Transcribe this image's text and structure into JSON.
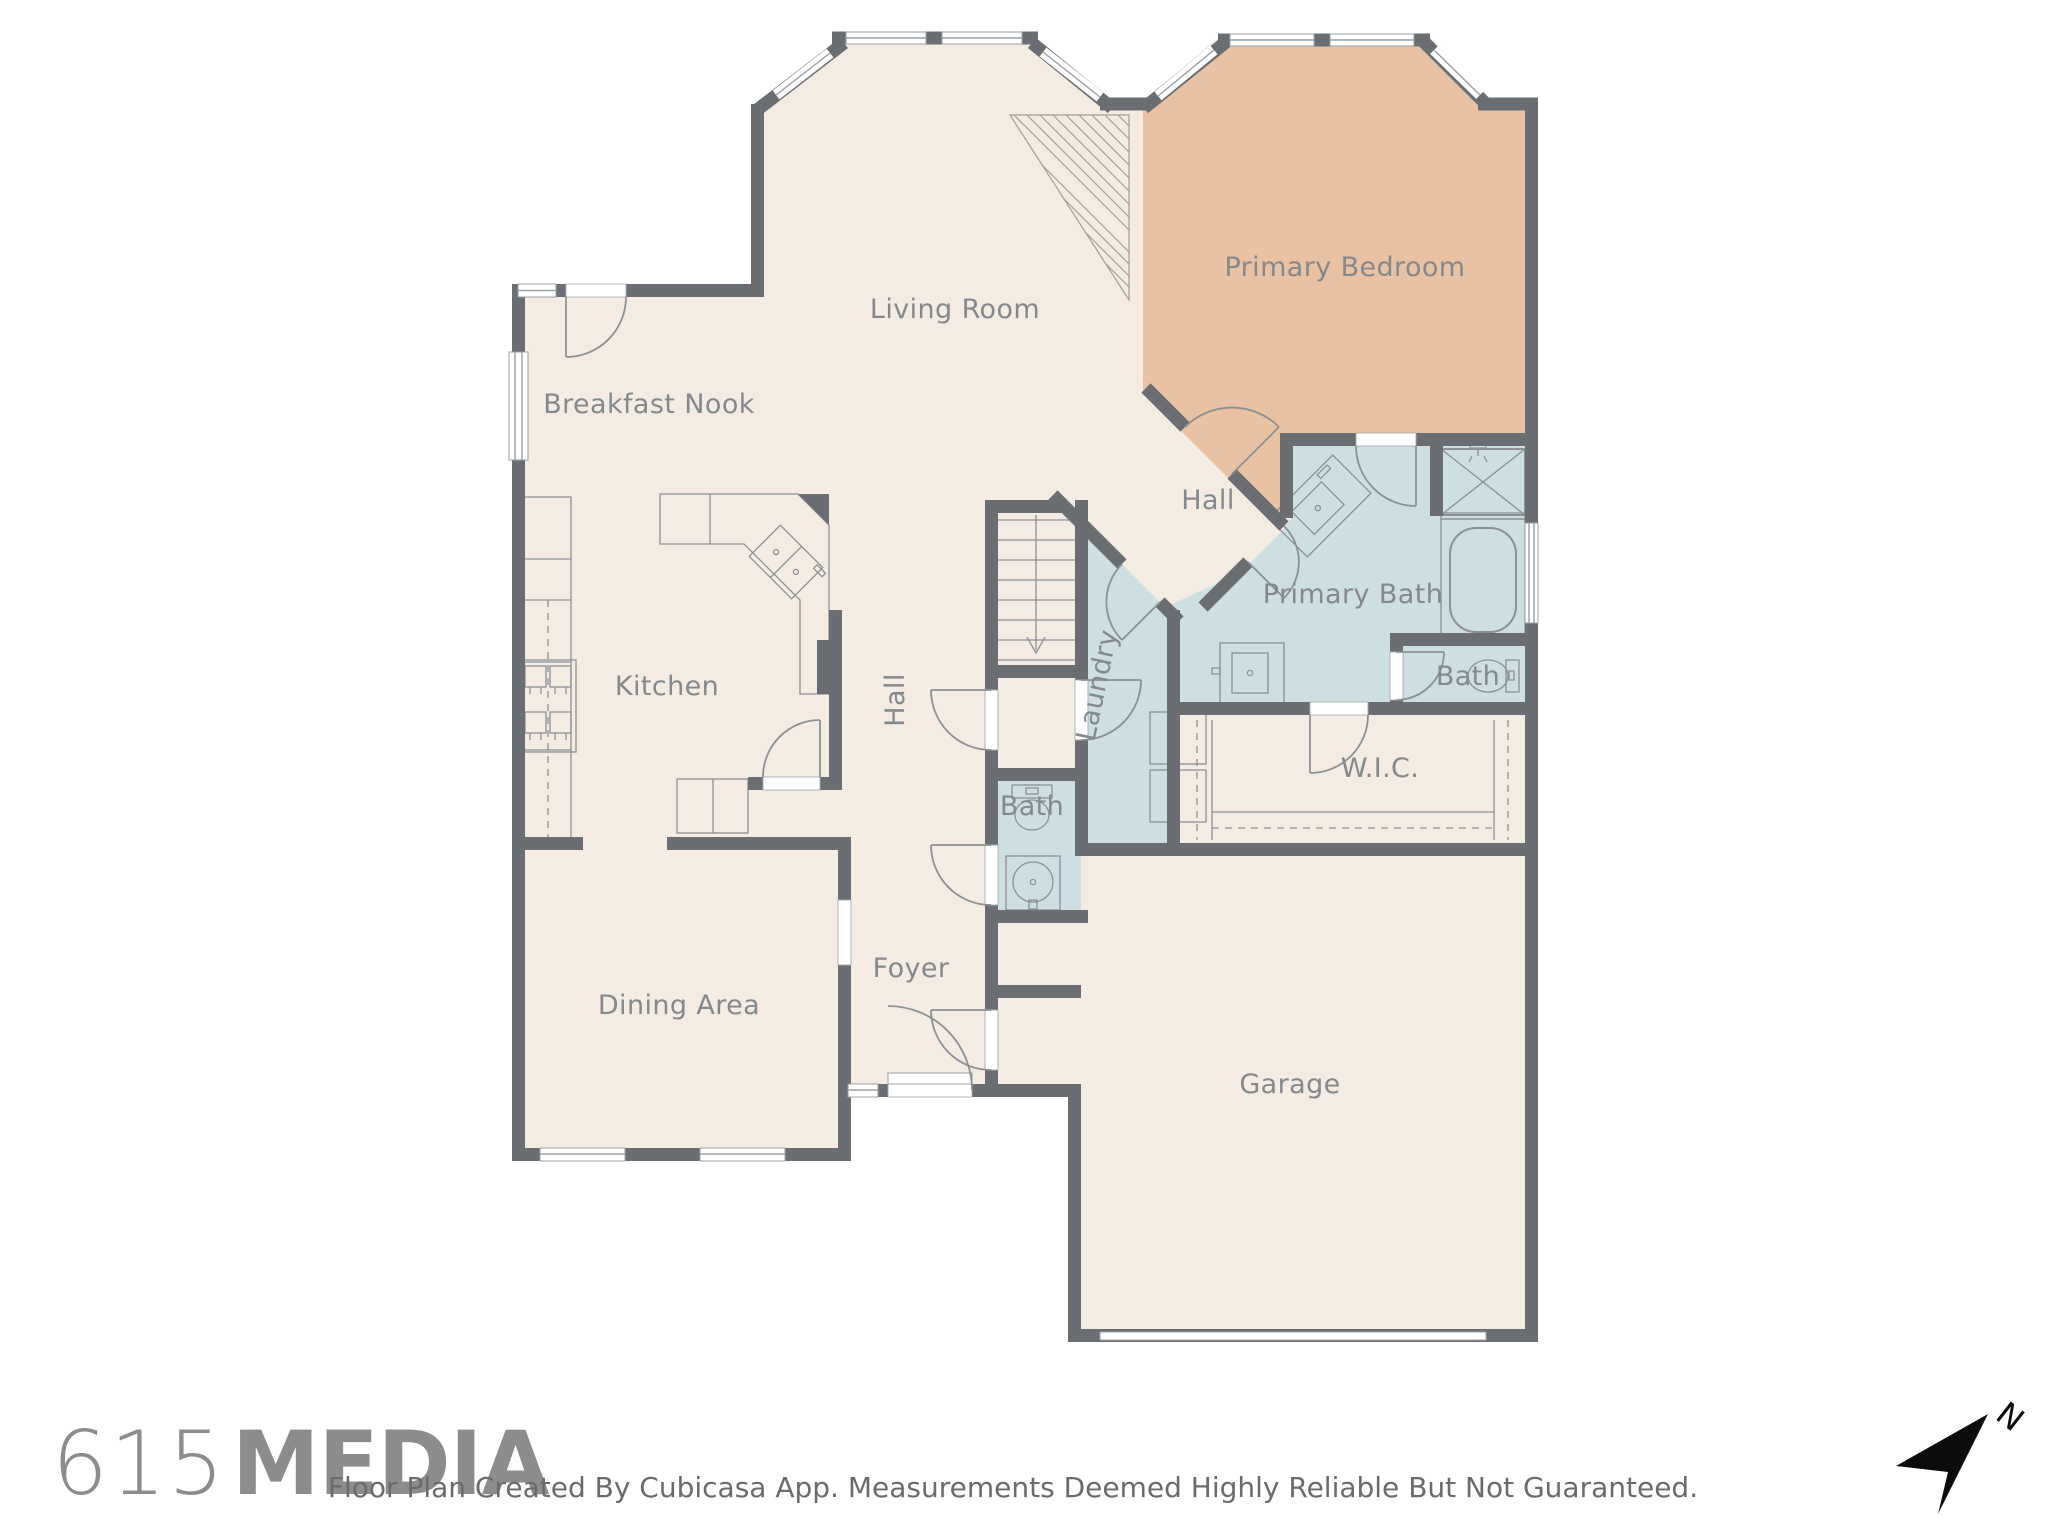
{
  "floorplan": {
    "rooms": [
      {
        "id": "living-room",
        "label": "Living Room"
      },
      {
        "id": "primary-bedroom",
        "label": "Primary Bedroom"
      },
      {
        "id": "breakfast-nook",
        "label": "Breakfast Nook"
      },
      {
        "id": "hall-upper",
        "label": "Hall"
      },
      {
        "id": "primary-bath",
        "label": "Primary Bath"
      },
      {
        "id": "bath-toilet-room",
        "label": "Bath"
      },
      {
        "id": "wic",
        "label": "W.I.C."
      },
      {
        "id": "laundry",
        "label": "Laundry"
      },
      {
        "id": "hall-vertical",
        "label": "Hall"
      },
      {
        "id": "kitchen",
        "label": "Kitchen"
      },
      {
        "id": "bath-lower",
        "label": "Bath"
      },
      {
        "id": "foyer",
        "label": "Foyer"
      },
      {
        "id": "dining-area",
        "label": "Dining Area"
      },
      {
        "id": "garage",
        "label": "Garage"
      }
    ],
    "colors": {
      "floor": "#f4ece3",
      "bedroom_fill": "#e8c2a2",
      "wet_room_fill": "#cedfe2",
      "wall": "#6a6e72",
      "label_text": "#84898d"
    }
  },
  "footer": {
    "logo_prefix": "615",
    "logo_suffix": "MEDIA",
    "disclaimer": "Floor Plan Created By Cubicasa App. Measurements Deemed Highly Reliable But Not Guaranteed."
  },
  "compass": {
    "label": "N"
  }
}
